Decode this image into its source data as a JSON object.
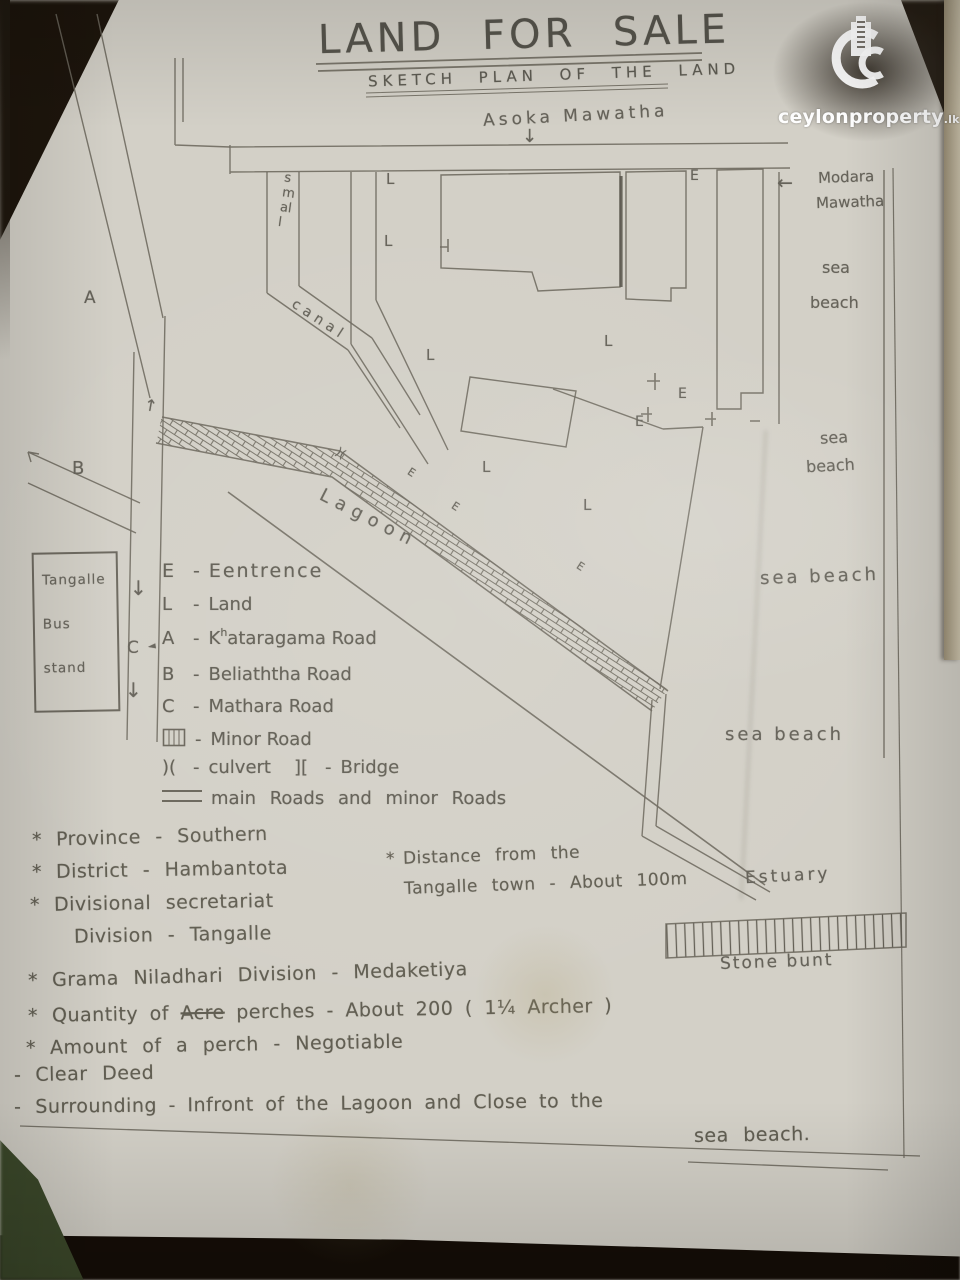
{
  "header": {
    "title": "LAND FOR SALE",
    "subtitle": "SKETCH PLAN OF THE LAND"
  },
  "brand": {
    "bold": "ceylon",
    "normal": "property",
    "tld": ".lk"
  },
  "map": {
    "top_road": "Asoka Mawatha",
    "right_road_line1": "Modara",
    "right_road_line2": "Mawatha",
    "sea": "sea",
    "beach": "beach",
    "sea_beach": "sea beach",
    "canal_small": "small",
    "canal": "canal",
    "lagoon": "Lagoon",
    "estuary": "Estuary",
    "stone_bunt": "Stone bunt",
    "bus_stand": {
      "line1": "Tangalle",
      "line2": "Bus",
      "line3": "stand"
    },
    "road_a": "A",
    "road_b": "B",
    "road_c": "C",
    "marks": {
      "land": "L",
      "entrance": "E",
      "culvert": ")(",
      "arrow_down": "↓",
      "arrow_up": "↑",
      "arrow_left": "←",
      "pointer": "◄"
    }
  },
  "legend": {
    "sep": "-",
    "items": [
      {
        "sym": "E",
        "label": "Eentrence"
      },
      {
        "sym": "L",
        "label": "Land"
      },
      {
        "sym": "A",
        "label": "Kataragama Road",
        "sup": "h"
      },
      {
        "sym": "B",
        "label": "Beliaththa Road"
      },
      {
        "sym": "C",
        "label": "Mathara Road"
      },
      {
        "sym": "minor-road-icon",
        "label": "Minor Road"
      },
      {
        "sym": ")(",
        "label": "culvert",
        "sym2": "][",
        "label2": "Bridge"
      },
      {
        "sym": "=",
        "label": "main Roads and minor Roads"
      }
    ]
  },
  "notes": {
    "distance_bullet": "*",
    "distance_line1": "Distance from the",
    "distance_line2": "Tangalle town - About 100m"
  },
  "details": [
    {
      "bullet": "*",
      "text": "Province  -  Southern"
    },
    {
      "bullet": "*",
      "text": "District  -  Hambantota"
    },
    {
      "bullet": "*",
      "text": "Divisional  secretariat"
    },
    {
      "bullet": "",
      "text": "Division - Tangalle"
    },
    {
      "bullet": "*",
      "text": "Grama  Niladhari  Division - Medaketiya"
    },
    {
      "bullet": "*",
      "pre": "Quantity  of  ",
      "struck": "Acre",
      "post": " perches -  About 200   ( 1¼ Archer )"
    },
    {
      "bullet": "*",
      "text": "Amount  of  a  perch -  Negotiable"
    },
    {
      "bullet": "-",
      "text": "Clear  Deed"
    },
    {
      "bullet": "-",
      "text": "Surrounding  -  Infront  of  the  Lagoon  and  Close  to  the"
    },
    {
      "bullet": "",
      "text": "sea beach."
    }
  ]
}
